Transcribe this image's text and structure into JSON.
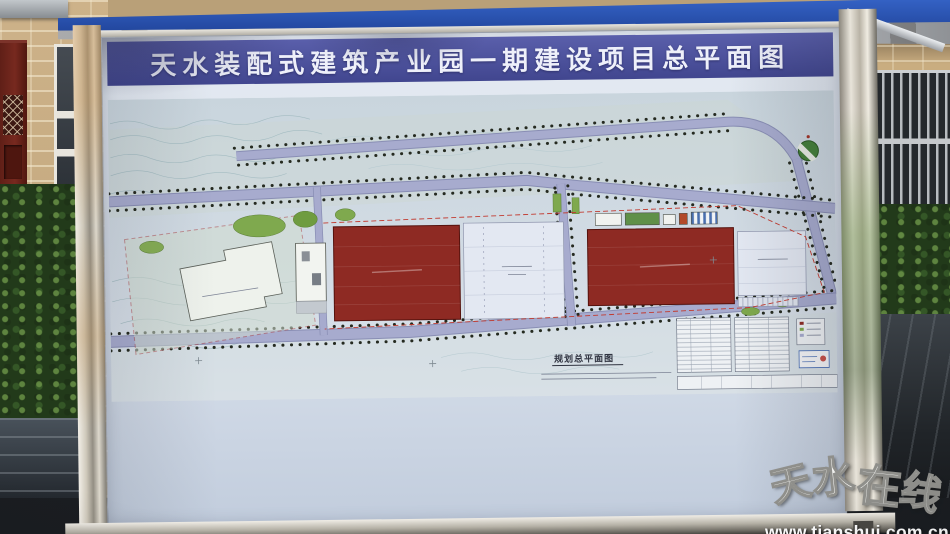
{
  "scene": {
    "watermark": {
      "brand_chars": [
        "天",
        "水",
        "在",
        "线"
      ],
      "url": "www.tianshui.com.cn"
    }
  },
  "board": {
    "title": "天水装配式建筑产业园一期建设项目总平面图"
  },
  "plan": {
    "caption": "规划总平面图",
    "colors": {
      "banner_blue": "#4b4fa4",
      "canopy_blue": "#1f47a0",
      "factory_red": "#8e2a23",
      "road_lavender": "#a7abce",
      "lawn_green": "#7fa94e",
      "paper": "#cfd9e2"
    }
  }
}
